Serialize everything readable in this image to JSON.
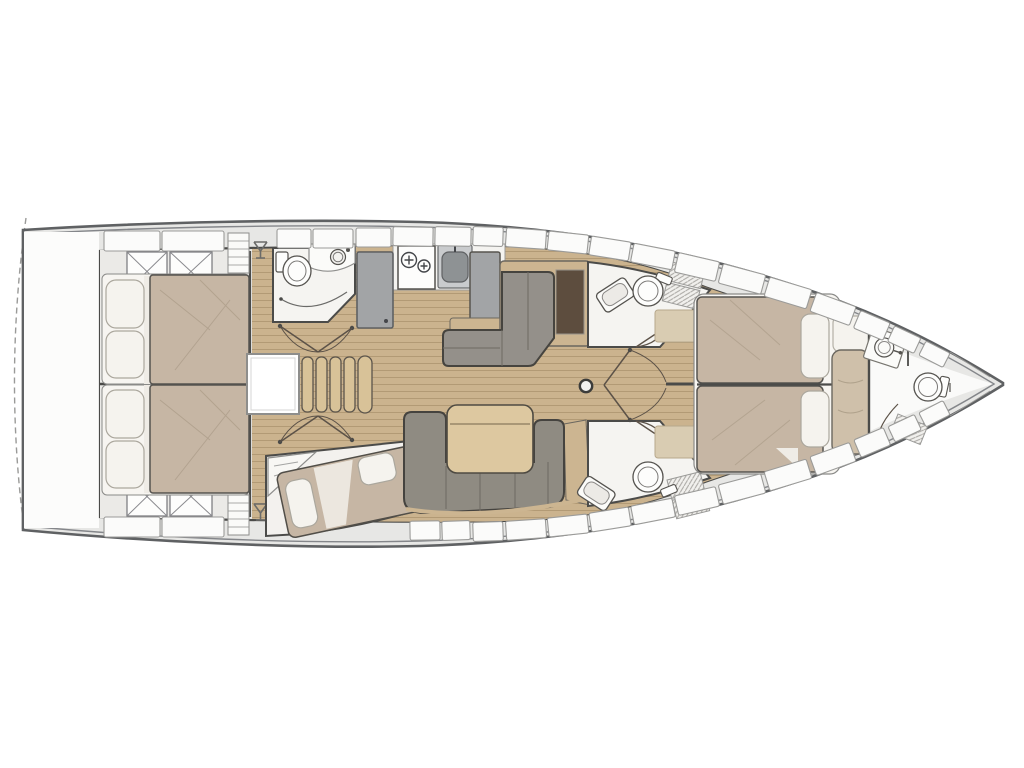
{
  "plan": {
    "title_semantic": "sailboat-interior-deck-plan",
    "orientation": "bow-right",
    "palette": {
      "hull_stroke": "#5f6163",
      "hull_inner_stroke": "#84868a",
      "wall_stroke": "#4b4b49",
      "deck_band": "#e7e7e5",
      "locker_fill": "#fbfbfa",
      "locker_stroke": "#9b9b99",
      "wood_floor": "#cbb38e",
      "wood_plank_line": "#b29a75",
      "room_floor": "#f5f4f1",
      "cabin_floor": "#ebeae7",
      "mattress": "#c6b6a4",
      "mattress_stroke": "#55534f",
      "pillow": "#f5f3ee",
      "pillow_stroke": "#aba79d",
      "sheet": "#efece6",
      "upholstery": "#8f8b82",
      "upholstery_stroke": "#45433f",
      "dinette_cushion": "#94908a",
      "table_wood": "#ddc8a0",
      "trim_wood": "#ccb591",
      "appliance_gray": "#a2a4a6",
      "sink_basin": "#8e9294",
      "cabinet_dark": "#5d4d3e",
      "chaise": "#cfc0aa",
      "stair_tread": "#d8c298",
      "fixture_stroke": "#55534f",
      "grate_line": "#a9a7a3",
      "door_line": "#5c5248"
    },
    "areas": [
      {
        "name": "swim-platform",
        "side": "stern"
      },
      {
        "name": "aft-cabin-port",
        "furniture": [
          "double-berth",
          "storage-boxes"
        ]
      },
      {
        "name": "aft-cabin-starboard",
        "furniture": [
          "double-berth",
          "storage-boxes"
        ]
      },
      {
        "name": "aft-head",
        "fixtures": [
          "toilet",
          "washbasin",
          "shower-screen"
        ]
      },
      {
        "name": "galley",
        "fixtures": [
          "refrigerator",
          "two-burner-stove",
          "sink"
        ]
      },
      {
        "name": "dinette",
        "furniture": [
          "l-shaped-settee",
          "dark-sideboard"
        ]
      },
      {
        "name": "salon",
        "furniture": [
          "u-shaped-sofa",
          "folding-table",
          "mast-post"
        ]
      },
      {
        "name": "companionway",
        "furniture": [
          "stairs",
          "engine-box"
        ]
      },
      {
        "name": "midship-head-port",
        "fixtures": [
          "toilet",
          "washbasin",
          "shower-grate"
        ]
      },
      {
        "name": "midship-head-starboard",
        "fixtures": [
          "toilet",
          "washbasin",
          "shower-grate"
        ]
      },
      {
        "name": "third-cabin",
        "furniture": [
          "angled-double-berth",
          "wardrobe"
        ]
      },
      {
        "name": "owners-cabin",
        "furniture": [
          "island-double-berth",
          "chaise-longue"
        ]
      },
      {
        "name": "bow-head",
        "fixtures": [
          "toilet",
          "washbasin",
          "shower-grate"
        ]
      }
    ],
    "icons": [
      "wine-glass-icon",
      "stove-burner-icon",
      "sink-icon",
      "toilet-icon",
      "shower-grate-icon",
      "mast-post-icon",
      "door-swing-icon",
      "storage-x-icon"
    ]
  }
}
